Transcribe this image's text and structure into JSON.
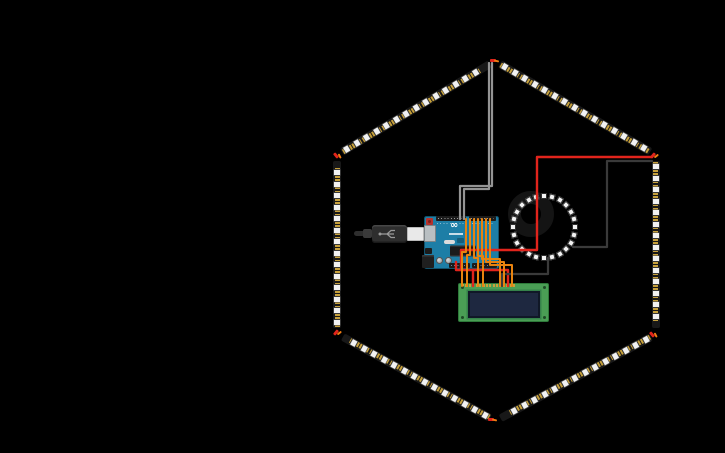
{
  "app": {
    "title": "Circuit diagram canvas",
    "background": "#000000",
    "width": 725,
    "height": 453
  },
  "colors": {
    "bg": "#000000",
    "wire_red": "#e1241c",
    "wire_black": "#3a3a3a",
    "wire_gray": "#949494",
    "wire_orange": "#e8830f",
    "strip_pcb": "#181818",
    "strip_pad_gold": "#c7a13c",
    "strip_led_white": "#f2f2f2",
    "ring_pcb": "#141414",
    "arduino_board": "#1d7ea6",
    "header_black": "#1b1b1b",
    "usb_silver": "#b9bfc2",
    "usb_cable_black": "#2e2e2e",
    "usb_plug_white": "#e9e9e9",
    "lcd_board_green": "#4a9e55",
    "lcd_border_green": "#2e7a3a",
    "lcd_screen_navy": "#1e2840",
    "connector_red": "#e1251b",
    "connector_orange": "#f07d12"
  },
  "components": {
    "hexagon_strips": {
      "label": "NeoPixel LED strip hexagon",
      "strip_width": 8,
      "led_pitch": 11.5,
      "end_inset": 6,
      "vertices": [
        {
          "x": 495,
          "y": 61
        },
        {
          "x": 656,
          "y": 155
        },
        {
          "x": 656,
          "y": 334
        },
        {
          "x": 495,
          "y": 421
        },
        {
          "x": 337,
          "y": 334
        },
        {
          "x": 337,
          "y": 155
        }
      ],
      "sides": [
        [
          5,
          0
        ],
        [
          0,
          1
        ],
        [
          1,
          2
        ],
        [
          2,
          3
        ],
        [
          3,
          4
        ],
        [
          4,
          5
        ]
      ],
      "connectors": [
        {
          "x": 495,
          "y": 61,
          "rot": 0
        },
        {
          "x": 655,
          "y": 156,
          "rot": -50
        },
        {
          "x": 654,
          "y": 335,
          "rot": 50
        },
        {
          "x": 493,
          "y": 420,
          "rot": 0
        },
        {
          "x": 338,
          "y": 333,
          "rot": -50
        },
        {
          "x": 338,
          "y": 156,
          "rot": 50
        }
      ]
    },
    "neopixel_ring": {
      "label": "NeoPixel ring",
      "cx": 544,
      "cy": 227,
      "pcb_outer_radius": 36,
      "pcb_thickness": 13,
      "led_count": 24,
      "led_orbit_radius": 31,
      "led_size": 6
    },
    "arduino": {
      "label": "Arduino Uno",
      "x": 424,
      "y": 216,
      "w": 75,
      "h": 53,
      "logo_glyph": "∞"
    },
    "usb_cable": {
      "label": "USB cable"
    },
    "lcd": {
      "label": "16x2 character LCD",
      "x": 458,
      "y": 283,
      "w": 91,
      "h": 39,
      "pin_count": 16,
      "pin_start_x": 461,
      "pin_pitch": 3.4,
      "pin_y": 284,
      "screen": {
        "x": 467,
        "y": 290,
        "w": 72,
        "h": 27
      }
    }
  },
  "wires": [
    {
      "name": "strip-data-wire-a",
      "color": "wire_gray",
      "width": 2.2,
      "points": [
        [
          460,
          219
        ],
        [
          460,
          186
        ],
        [
          492,
          186
        ],
        [
          492,
          63
        ]
      ]
    },
    {
      "name": "strip-data-wire-b",
      "color": "wire_gray",
      "width": 2.2,
      "points": [
        [
          464,
          219
        ],
        [
          464,
          189
        ],
        [
          489,
          189
        ],
        [
          489,
          63
        ]
      ]
    },
    {
      "name": "power-wire-red",
      "color": "wire_red",
      "width": 2.4,
      "points": [
        [
          652,
          157
        ],
        [
          537,
          157
        ],
        [
          537,
          250
        ],
        [
          461,
          250
        ],
        [
          461,
          270
        ],
        [
          473,
          270
        ],
        [
          473,
          286
        ]
      ]
    },
    {
      "name": "power-wire-red-branch",
      "color": "wire_red",
      "width": 2.4,
      "points": [
        [
          473,
          270
        ],
        [
          508,
          270
        ],
        [
          508,
          286
        ]
      ]
    },
    {
      "name": "power-wire-red-stub",
      "color": "wire_red",
      "width": 2.4,
      "points": [
        [
          456,
          262
        ],
        [
          456,
          270
        ],
        [
          462,
          270
        ]
      ]
    },
    {
      "name": "ground-wire-strip-to-ring",
      "color": "wire_black",
      "width": 2.2,
      "points": [
        [
          652,
          161
        ],
        [
          607,
          161
        ],
        [
          607,
          247
        ],
        [
          573,
          247
        ]
      ]
    },
    {
      "name": "ground-wire-ring-to-lcd",
      "color": "wire_black",
      "width": 2.2,
      "points": [
        [
          548,
          258
        ],
        [
          548,
          274
        ],
        [
          502,
          274
        ],
        [
          502,
          286
        ]
      ]
    },
    {
      "name": "lcd-wire-1",
      "color": "wire_orange",
      "width": 2,
      "points": [
        [
          466,
          219
        ],
        [
          466,
          252
        ],
        [
          462,
          252
        ],
        [
          462,
          286
        ]
      ]
    },
    {
      "name": "lcd-wire-2",
      "color": "wire_orange",
      "width": 2,
      "points": [
        [
          470,
          219
        ],
        [
          470,
          255
        ],
        [
          467,
          255
        ],
        [
          467,
          286
        ]
      ]
    },
    {
      "name": "lcd-wire-3",
      "color": "wire_orange",
      "width": 2,
      "points": [
        [
          474,
          219
        ],
        [
          474,
          258
        ],
        [
          478,
          258
        ],
        [
          478,
          286
        ]
      ]
    },
    {
      "name": "lcd-wire-4",
      "color": "wire_orange",
      "width": 2,
      "points": [
        [
          478,
          219
        ],
        [
          478,
          256
        ],
        [
          483,
          256
        ],
        [
          483,
          286
        ]
      ]
    },
    {
      "name": "lcd-wire-5",
      "color": "wire_orange",
      "width": 2,
      "points": [
        [
          482,
          219
        ],
        [
          482,
          259
        ],
        [
          500,
          259
        ],
        [
          500,
          286
        ]
      ]
    },
    {
      "name": "lcd-wire-6",
      "color": "wire_orange",
      "width": 2,
      "points": [
        [
          486,
          219
        ],
        [
          486,
          262
        ],
        [
          504,
          262
        ],
        [
          504,
          286
        ]
      ]
    },
    {
      "name": "lcd-wire-7",
      "color": "wire_orange",
      "width": 2,
      "points": [
        [
          490,
          219
        ],
        [
          490,
          265
        ],
        [
          512,
          265
        ],
        [
          512,
          286
        ]
      ]
    }
  ]
}
